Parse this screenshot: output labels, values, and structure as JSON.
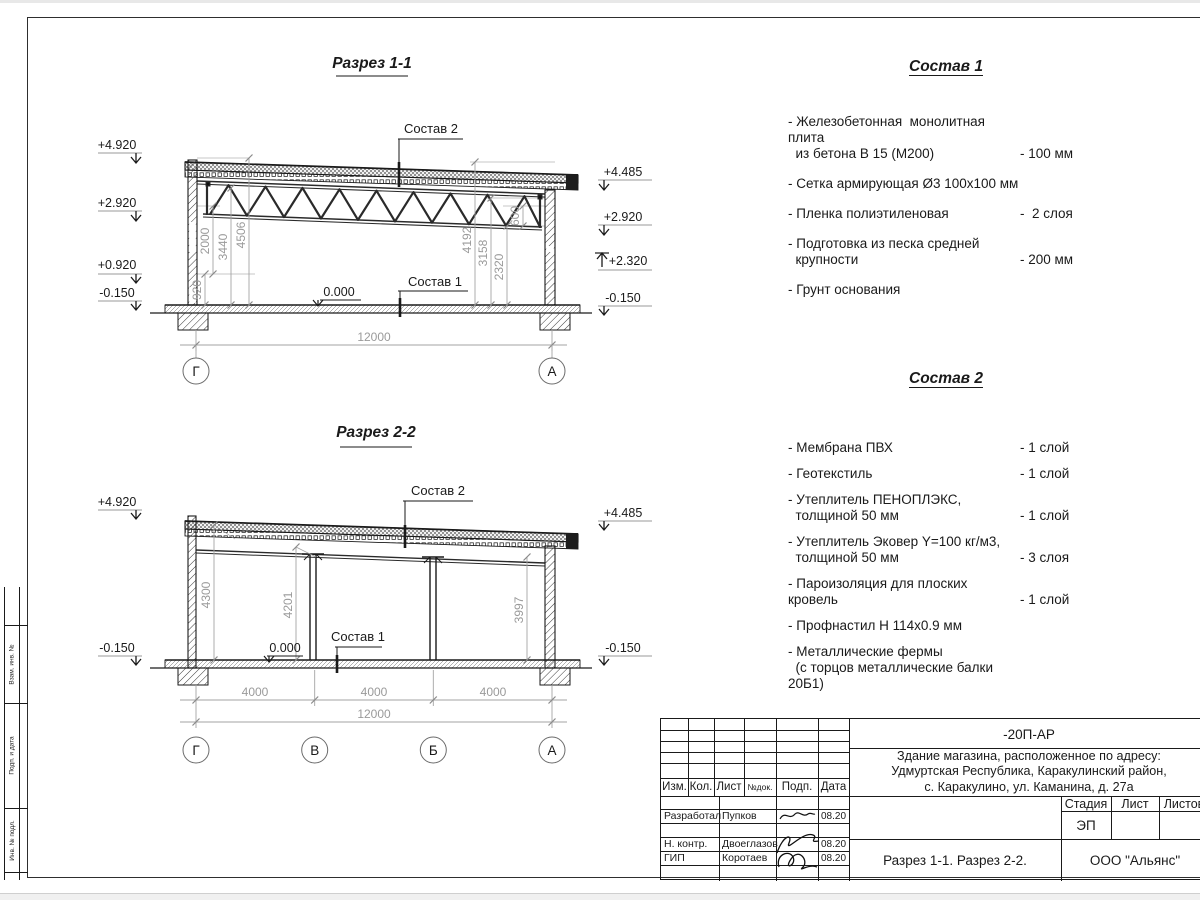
{
  "sheet": {
    "section1": {
      "title": "Разрез 1-1",
      "elev_left": [
        "+4.920",
        "+2.920",
        "+0.920",
        "-0.150"
      ],
      "elev_right": [
        "+4.485",
        "+2.920",
        "+2.320",
        "-0.150"
      ],
      "dims_left": [
        "920",
        "2000",
        "3440",
        "4506"
      ],
      "dims_right": [
        "4192",
        "3158",
        "2320",
        "600"
      ],
      "total_dim": "12000",
      "zero_mark": "0.000",
      "sostav1_ref": "Состав 1",
      "sostav2_ref": "Состав 2",
      "axes": [
        "Г",
        "А"
      ]
    },
    "section2": {
      "title": "Разрез 2-2",
      "elev_left": [
        "+4.920",
        "-0.150"
      ],
      "elev_right": [
        "+4.485",
        "-0.150"
      ],
      "dims": [
        "4300",
        "4201",
        "3997"
      ],
      "span_dims": [
        "4000",
        "4000",
        "4000"
      ],
      "total_dim": "12000",
      "zero_mark": "0.000",
      "sostav1_ref": "Состав 1",
      "sostav2_ref": "Состав 2",
      "axes": [
        "Г",
        "В",
        "Б",
        "А"
      ]
    },
    "sostav1": {
      "title": "Состав 1",
      "items": [
        {
          "name": "- Железобетонная  монолитная плита\n  из бетона В 15 (М200)",
          "value": "- 100 мм"
        },
        {
          "name": "- Сетка армирующая Ø3 100х100 мм",
          "value": ""
        },
        {
          "name": "- Пленка полиэтиленовая",
          "value": "-  2 слоя"
        },
        {
          "name": "- Подготовка из песка средней\n  крупности",
          "value": "- 200 мм"
        },
        {
          "name": "- Грунт основания",
          "value": ""
        }
      ]
    },
    "sostav2": {
      "title": "Состав 2",
      "items": [
        {
          "name": "- Мембрана ПВХ",
          "value": "- 1 слой"
        },
        {
          "name": "- Геотекстиль",
          "value": "- 1 слой"
        },
        {
          "name": "- Утеплитель ПЕНОПЛЭКС,\n  толщиной 50 мм",
          "value": "- 1 слой"
        },
        {
          "name": "- Утеплитель Эковер Y=100 кг/м3,\n  толщиной 50 мм",
          "value": "- 3 слоя"
        },
        {
          "name": "- Пароизоляция для плоских кровель",
          "value": "- 1 слой"
        },
        {
          "name": "- Профнастил Н 114х0.9 мм",
          "value": ""
        },
        {
          "name": "- Металлические фермы\n  (с торцов металлические балки 20Б1)",
          "value": ""
        }
      ]
    },
    "titleblock": {
      "doc_code": "-20П-АР",
      "project": "Здание магазина, расположенное по адресу:\nУдмуртская Республика, Каракулинский район,\nс. Каракулино, ул. Каманина, д. 27а",
      "cols": [
        "Изм.",
        "Кол.",
        "Лист",
        "№док.",
        "Подп.",
        "Дата"
      ],
      "rows": [
        {
          "role": "Разработал",
          "name": "Пупков",
          "date": "08.20"
        },
        {
          "role": "Н. контр.",
          "name": "Двоеглазов",
          "date": "08.20"
        },
        {
          "role": "ГИП",
          "name": "Коротаев",
          "date": "08.20"
        }
      ],
      "stage_label": "Стадия",
      "sheet_label": "Лист",
      "sheets_label": "Листов",
      "stage_value": "ЭП",
      "subtitle": "Разрез 1-1. Разрез 2-2.",
      "company": "ООО \"Альянс\""
    },
    "side_strip": {
      "labels": [
        "Взам. инв. №",
        "Подп. и дата",
        "Инв. № подл."
      ]
    }
  }
}
